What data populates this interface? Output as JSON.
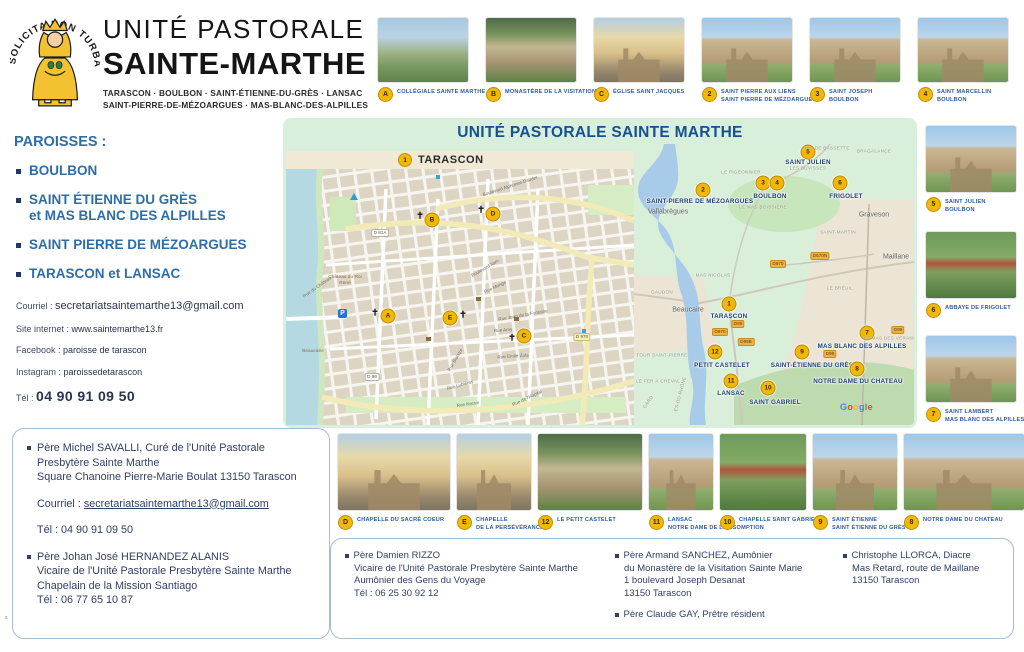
{
  "header": {
    "motto": "SOLICITA NON TURBATUR",
    "title1": "UNITÉ PASTORALE",
    "title2": "SAINTE-MARTHE",
    "sub1": "TARASCON · BOULBON · SAINT-ÉTIENNE-DU-GRÈS · LANSAC",
    "sub2": "SAINT-PIERRE-DE-MÉZOARGUES · MAS-BLANC-DES-ALPILLES"
  },
  "top_photos": [
    {
      "badge": "A",
      "line1": "Collégiale Sainte Marthe",
      "line2": "",
      "v": 4
    },
    {
      "badge": "B",
      "line1": "Monastère de la Visitation",
      "line2": "",
      "v": 2
    },
    {
      "badge": "C",
      "line1": "Église Saint Jacques",
      "line2": "",
      "v": 3
    },
    {
      "badge": "2",
      "line1": "Saint Pierre aux Liens",
      "line2": "Saint Pierre de Mézoargues",
      "v": 1
    },
    {
      "badge": "3",
      "line1": "Saint Joseph",
      "line2": "boulbon",
      "v": 1
    },
    {
      "badge": "4",
      "line1": "Saint Marcellin",
      "line2": "boulbon",
      "v": 1
    }
  ],
  "right_photos": [
    {
      "badge": "5",
      "line1": "Saint Julien",
      "line2": "boulbon",
      "v": 1
    },
    {
      "badge": "6",
      "line1": "Abbaye de Frigolet",
      "line2": "",
      "v": 5
    },
    {
      "badge": "7",
      "line1": "Saint Lambert",
      "line2": "Mas Blanc des Alpilles",
      "v": 1
    }
  ],
  "bottom_photos": [
    {
      "badge": "D",
      "line1": "Chapelle du Sacré Coeur",
      "line2": "",
      "v": 3,
      "w": 112
    },
    {
      "badge": "E",
      "line1": "Chapelle",
      "line2": "de la Persévérance",
      "v": 3,
      "w": 74
    },
    {
      "badge": "12",
      "line1": "Le Petit Castelet",
      "line2": "",
      "v": 2,
      "w": 104
    },
    {
      "badge": "11",
      "line1": "Lansac",
      "line2": "Notre Dame de l'Assomption",
      "v": 1,
      "w": 64
    },
    {
      "badge": "10",
      "line1": "Chapelle Saint Gabriel",
      "line2": "",
      "v": 5,
      "w": 86
    },
    {
      "badge": "9",
      "line1": "Saint Étienne",
      "line2": "Saint Étienne du Grès",
      "v": 1,
      "w": 84
    },
    {
      "badge": "8",
      "line1": "Notre Dame du Chateau",
      "line2": "",
      "v": 1,
      "w": 120
    }
  ],
  "paroisses": {
    "heading": "PAROISSES :",
    "items": [
      {
        "l1": "BOULBON",
        "l2": ""
      },
      {
        "l1": "SAINT ÉTIENNE DU GRÈS",
        "l2": "et MAS BLANC DES ALPILLES"
      },
      {
        "l1": "SAINT PIERRE DE MÉZOARGUES",
        "l2": ""
      },
      {
        "l1": "TARASCON et LANSAC",
        "l2": ""
      }
    ]
  },
  "contact": [
    {
      "label": "Courriel : ",
      "value": "secretariatsaintemarthe13@gmail.com"
    },
    {
      "label": "Site internet : ",
      "value": "www.saintemarthe13.fr"
    },
    {
      "label": "Facebook : ",
      "value": "paroisse de tarascon"
    },
    {
      "label": "Instagram : ",
      "value": "paroissedetarascon"
    },
    {
      "label": "Tél : ",
      "value": "04 90 91 09 50"
    }
  ],
  "map": {
    "title": "UNITÉ PASTORALE SAINTE MARTHE",
    "band_badge": "1",
    "band_label": "TARASCON",
    "city_markers": [
      {
        "badge": "B",
        "x": 146,
        "y": 51,
        "cx": 134,
        "cy": 47
      },
      {
        "badge": "D",
        "x": 207,
        "y": 45,
        "cx": 195,
        "cy": 41
      },
      {
        "badge": "A",
        "x": 102,
        "y": 147,
        "cx": 89,
        "cy": 144
      },
      {
        "badge": "E",
        "x": 164,
        "y": 149,
        "cx": 177,
        "cy": 146
      },
      {
        "badge": "C",
        "x": 238,
        "y": 167,
        "cx": 226,
        "cy": 169
      }
    ],
    "city_streets": [
      {
        "t": "Boulevard Alphonse Daudet",
        "x": 224,
        "y": 17,
        "r": -18
      },
      {
        "t": "Boulevard Itam",
        "x": 199,
        "y": 99,
        "r": -30
      },
      {
        "t": "Rue du Château",
        "x": 31,
        "y": 118,
        "r": -35
      },
      {
        "t": "Rue Monge",
        "x": 209,
        "y": 118,
        "r": -25
      },
      {
        "t": "Rue Jean de la Fontaine",
        "x": 237,
        "y": 146,
        "r": -10
      },
      {
        "t": "Rue Amy",
        "x": 217,
        "y": 161,
        "r": -5
      },
      {
        "t": "Rue Emile Zola",
        "x": 227,
        "y": 187,
        "r": -4
      },
      {
        "t": "Rue Blanqui",
        "x": 169,
        "y": 191,
        "r": -60
      },
      {
        "t": "Rue Lubières",
        "x": 174,
        "y": 216,
        "r": -15
      },
      {
        "t": "Rue Neuve",
        "x": 182,
        "y": 235,
        "r": -8
      },
      {
        "t": "Rue de l'Hôpital",
        "x": 241,
        "y": 229,
        "r": -25
      }
    ],
    "city_chips": [
      {
        "t": "D 81A",
        "x": 94,
        "y": 64
      },
      {
        "t": "D 99",
        "x": 86,
        "y": 208
      },
      {
        "t": "D 970",
        "x": 296,
        "y": 168,
        "yel": true
      }
    ],
    "city_places": [
      {
        "t": "Château du Roi René",
        "x": 38,
        "y": 106
      },
      {
        "t": "Beaucaire",
        "x": 6,
        "y": 180
      }
    ],
    "region_markers": [
      {
        "badge": "5",
        "x": 174,
        "y": 8,
        "label": "SAINT JULIEN",
        "lx": 174,
        "ly": 15
      },
      {
        "badge": "2",
        "x": 69,
        "y": 46,
        "label": "SAINT-PIERRE DE MÉZOARGUES",
        "lx": 66,
        "ly": 54
      },
      {
        "badge": "3",
        "x": 129,
        "y": 39,
        "label": "",
        "lx": 0,
        "ly": 0
      },
      {
        "badge": "4",
        "x": 143,
        "y": 39,
        "label": "BOULBON",
        "lx": 136,
        "ly": 49
      },
      {
        "badge": "6",
        "x": 206,
        "y": 39,
        "label": "FRIGOLET",
        "lx": 212,
        "ly": 49
      },
      {
        "badge": "1",
        "x": 95,
        "y": 160,
        "label": "TARASCON",
        "lx": 95,
        "ly": 169
      },
      {
        "badge": "12",
        "x": 81,
        "y": 208,
        "label": "PETIT CASTELET",
        "lx": 88,
        "ly": 218
      },
      {
        "badge": "11",
        "x": 97,
        "y": 237,
        "label": "LANSAC",
        "lx": 97,
        "ly": 246
      },
      {
        "badge": "10",
        "x": 134,
        "y": 244,
        "label": "SAINT GABRIEL",
        "lx": 141,
        "ly": 255
      },
      {
        "badge": "9",
        "x": 168,
        "y": 208,
        "label": "SAINT-ÉTIENNE DU GRÈS",
        "lx": 178,
        "ly": 218
      },
      {
        "badge": "7",
        "x": 233,
        "y": 189,
        "label": "MAS BLANC DES ALPILLES",
        "lx": 228,
        "ly": 199
      },
      {
        "badge": "8",
        "x": 223,
        "y": 225,
        "label": "NOTRE DAME DU CHATEAU",
        "lx": 224,
        "ly": 234
      }
    ],
    "region_places_sm": [
      {
        "t": "MAS DE BASSETTE",
        "x": 192,
        "y": 4
      },
      {
        "t": "BRAGALANCE",
        "x": 240,
        "y": 7
      },
      {
        "t": "LE PIGEONNIER",
        "x": 107,
        "y": 28
      },
      {
        "t": "LES BUVISSES",
        "x": 174,
        "y": 24
      },
      {
        "t": "LE MAS BOISSIÈRE",
        "x": 129,
        "y": 63
      },
      {
        "t": "SAINT-MARTIN",
        "x": 204,
        "y": 88
      },
      {
        "t": "MAS NICOLAS",
        "x": 79,
        "y": 131
      },
      {
        "t": "LE BREUIL",
        "x": 206,
        "y": 144
      },
      {
        "t": "GAUDON",
        "x": 28,
        "y": 148
      },
      {
        "t": "TOUR SAINT-PIERRE",
        "x": 28,
        "y": 211
      },
      {
        "t": "LE FER À CHEVAL",
        "x": 24,
        "y": 237
      },
      {
        "t": "LE MAS DES VÉRANS",
        "x": 256,
        "y": 194
      },
      {
        "t": "GARD",
        "x": 14,
        "y": 258,
        "r": -55
      },
      {
        "t": "ES-DU-RHÔNE",
        "x": 46,
        "y": 250,
        "r": -75
      }
    ],
    "region_places_lg": [
      {
        "t": "Vallabrègues",
        "x": 34,
        "y": 68
      },
      {
        "t": "Graveson",
        "x": 240,
        "y": 71
      },
      {
        "t": "Maillane",
        "x": 262,
        "y": 113
      },
      {
        "t": "Beaucaire",
        "x": 54,
        "y": 166
      }
    ],
    "region_chips": [
      {
        "t": "D970",
        "x": 144,
        "y": 120
      },
      {
        "t": "D570N",
        "x": 186,
        "y": 112
      },
      {
        "t": "D99",
        "x": 104,
        "y": 180
      },
      {
        "t": "D970",
        "x": 86,
        "y": 188
      },
      {
        "t": "D99B",
        "x": 112,
        "y": 198
      },
      {
        "t": "D99",
        "x": 196,
        "y": 210
      },
      {
        "t": "D99",
        "x": 264,
        "y": 186
      }
    ],
    "google_letters": [
      {
        "c": "G",
        "color": "#4285F4"
      },
      {
        "c": "o",
        "color": "#EA4335"
      },
      {
        "c": "o",
        "color": "#FBBC05"
      },
      {
        "c": "g",
        "color": "#4285F4"
      },
      {
        "c": "l",
        "color": "#34A853"
      },
      {
        "c": "e",
        "color": "#EA4335"
      }
    ]
  },
  "box_left": {
    "b1_l1": "Père Michel SAVALLI, Curé de l'Unité Pastorale",
    "b1_l2": "Presbytère Sainte Marthe",
    "b1_l3": "Square Chanoine Pierre-Marie Boulat  13150 Tarascon",
    "courriel_label": "Courriel :",
    "courriel_value": "secretariatsaintemarthe13@gmail.com",
    "tel": "Tél : 04 90 91 09 50",
    "b2_l1": "Père Johan José HERNANDEZ ALANIS",
    "b2_l2": "Vicaire de l'Unité Pastorale Presbytère Sainte Marthe",
    "b2_l3": "Chapelain de la Mission Santiago",
    "b2_l4": "Tél : 06 77 65 10 87"
  },
  "box_right": {
    "col1": [
      "Père Damien RIZZO",
      "Vicaire de l'Unité Pastorale Presbytère Sainte Marthe",
      "Aumônier des Gens du Voyage",
      "Tél : 06 25 30 92 12"
    ],
    "col2a": [
      "Père Armand SANCHEZ, Aumônier",
      "du Monastère de la Visitation Sainte Marie",
      "1 boulevard Joseph Desanat",
      "13150 Tarascon"
    ],
    "col2b": [
      "Père Claude GAY, Prêtre résident"
    ],
    "col3": [
      "Christophe LLORCA, Diacre",
      "Mas Retard, route de Maillane",
      "13150 Tarascon"
    ]
  },
  "page_mark": "s"
}
